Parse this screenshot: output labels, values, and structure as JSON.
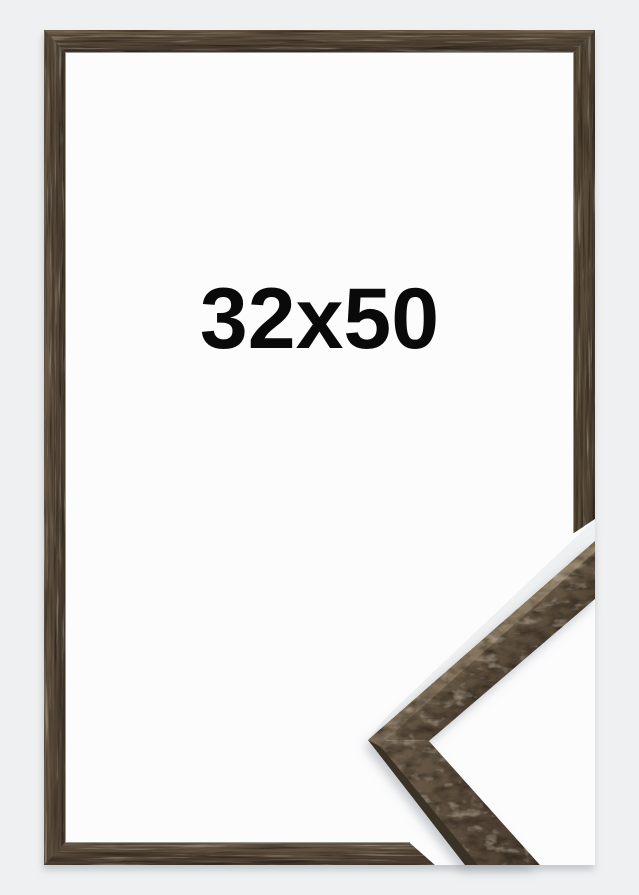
{
  "product": {
    "size_label": "32x50"
  },
  "scene": {
    "background_color": "#eef0f1",
    "paper_color": "#fcfcfd",
    "label_color": "#0a0a0a",
    "shadow_color": "#9aa0a6",
    "wood": {
      "light": "#6e5e4b",
      "mid": "#574939",
      "dark": "#473b2e",
      "top_face_light": "#95846c",
      "top_face": "#7a6a56",
      "side_face": "#3a3128",
      "seam": "#2e2620",
      "lip": "#241c15"
    }
  }
}
